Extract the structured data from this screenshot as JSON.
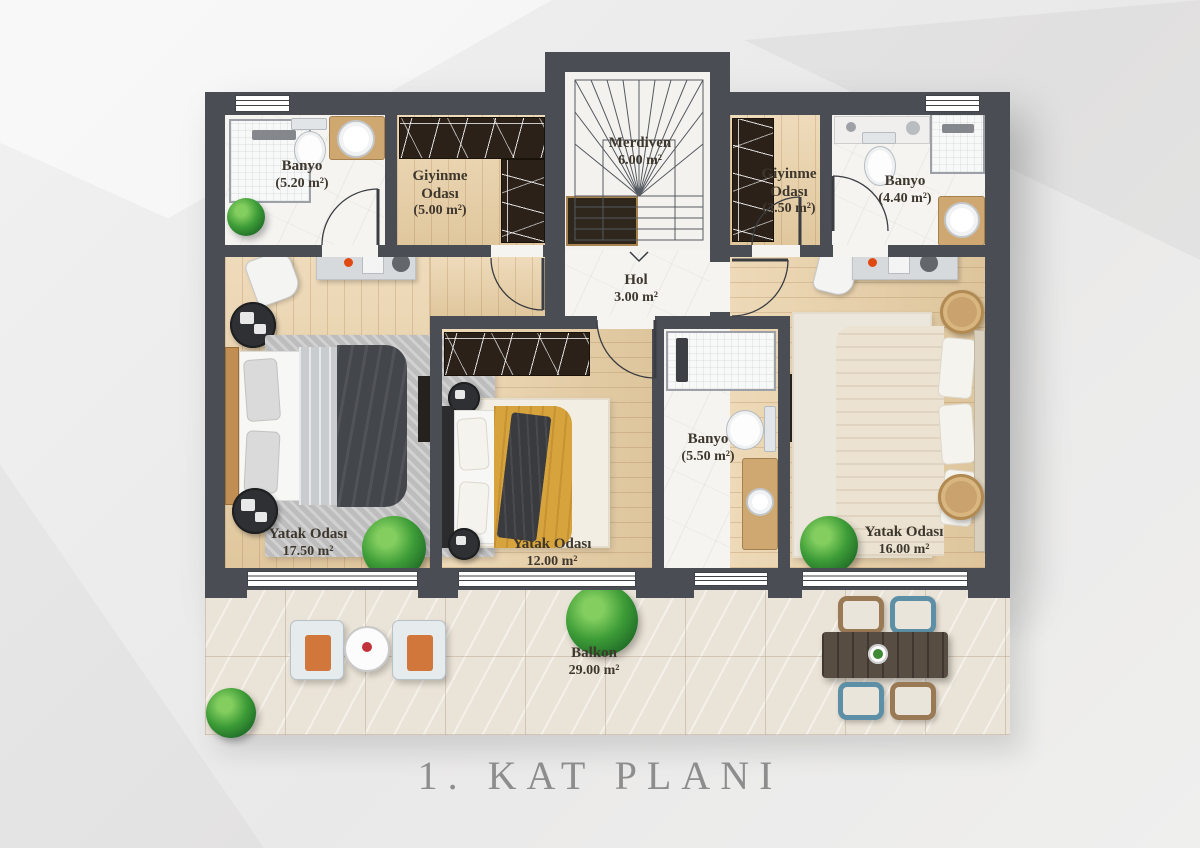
{
  "title": "1. KAT PLANI",
  "rooms": {
    "banyo1": {
      "name": "Banyo",
      "area": "(5.20 m²)"
    },
    "giyinme1": {
      "name": "Giyinme Odası",
      "area": "(5.00 m²)"
    },
    "merdiven": {
      "name": "Merdiven",
      "area": "6.00 m²"
    },
    "giyinme2": {
      "name": "Giyinme Odası",
      "area": "(3.50 m²)"
    },
    "banyo2": {
      "name": "Banyo",
      "area": "(4.40 m²)"
    },
    "hol": {
      "name": "Hol",
      "area": "3.00 m²"
    },
    "yatak1": {
      "name": "Yatak Odası",
      "area": "17.50 m²"
    },
    "yatak2": {
      "name": "Yatak Odası",
      "area": "12.00 m²"
    },
    "banyo3": {
      "name": "Banyo",
      "area": "(5.50 m²)"
    },
    "yatak3": {
      "name": "Yatak Odası",
      "area": "16.00 m²"
    },
    "balkon": {
      "name": "Balkon",
      "area": "29.00 m²"
    }
  },
  "colors": {
    "wall": "#4a4e54",
    "wood_floor": "#e9cfa4",
    "marble_floor": "#f5f4f1",
    "balcony_tile": "#eae3d7",
    "wardrobe": "#2b2119",
    "gold_duvet": "#d7a33c",
    "dark_duvet": "#43464b",
    "cream_duvet": "#ebe2d1",
    "title_text": "#8d8d8d",
    "label_text": "#3e372d"
  }
}
